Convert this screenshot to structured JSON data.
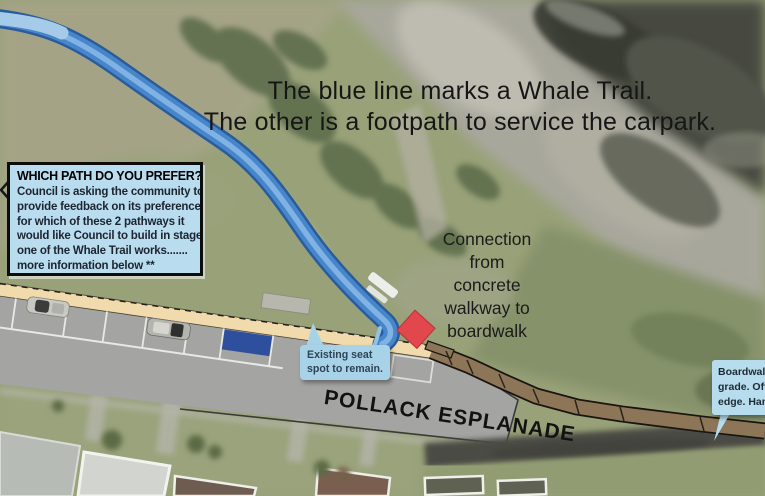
{
  "heading": {
    "line1": "The blue line marks a Whale Trail.",
    "line2": "The other is a footpath to service the carpark."
  },
  "info_box": {
    "title": "WHICH PATH DO YOU PREFER?",
    "body_lines": [
      "Council is asking the community to",
      "provide feedback on its preference",
      "for which of these 2 pathways it",
      "would like Council to build in stage",
      "one of the Whale Trail works.......",
      "more information below **"
    ]
  },
  "connection_label": {
    "lines": [
      "Connection",
      "from",
      "concrete",
      "walkway to",
      "boardwalk"
    ]
  },
  "seat_callout": {
    "lines": [
      "Existing seat",
      "spot to remain."
    ]
  },
  "boardwalk_callout": {
    "lines": [
      "Boardwalk",
      "grade. Off",
      "edge. Han"
    ]
  },
  "road_label": "POLLACK ESPLANADE",
  "map_features": {
    "whale_trail_line": "blue curved trail overlay",
    "footpath": "tan footpath strip along road",
    "boardwalk": "brown segmented boardwalk to the east",
    "road": "Pollack Esplanade gray road overlay",
    "connection_marker": "red diamond where walkway meets boardwalk",
    "parking_bay_highlight": "blue parking bay rectangle",
    "existing_seat": "white bench near trail end",
    "parked_cars": 2
  },
  "colors": {
    "trail_blue": "#4886cc",
    "trail_edge": "#2a5c9c",
    "trail_highlight": "#86b7e6",
    "footpath_tan": "#f1dbac",
    "boardwalk_brown": "#8d7557",
    "road_gray": "#a4a4a2",
    "marker_red": "#e2474d",
    "parking_blue": "#2d4f9e",
    "callout_blue": "#a7d2e8",
    "infobox_blue": "#b9ddef"
  }
}
